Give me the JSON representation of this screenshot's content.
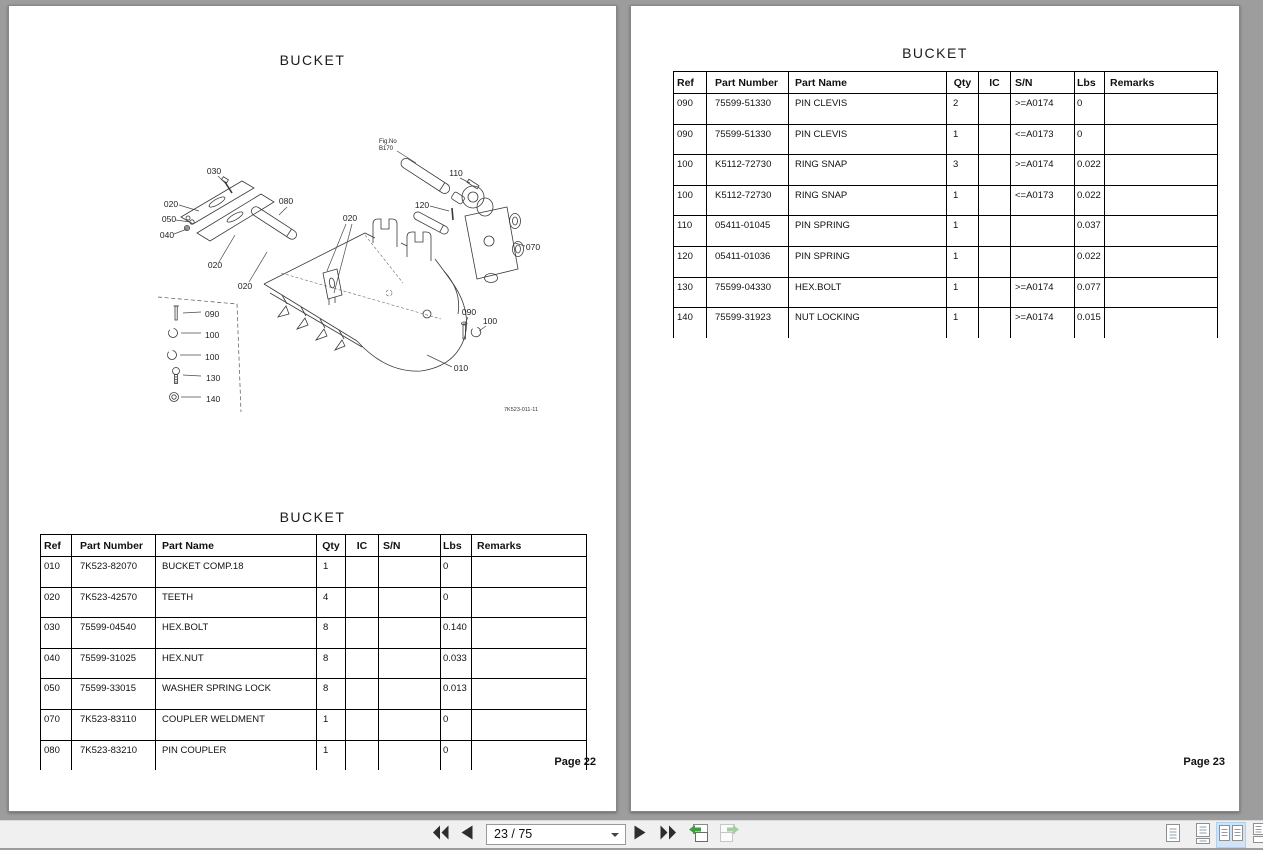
{
  "pages": {
    "left": {
      "title": "BUCKET",
      "table_title": "BUCKET",
      "footer": "Page 22",
      "diagram": {
        "fig_no_line1": "Fig.No",
        "fig_no_line2": "B170",
        "drawing_number": "7K523-011-11",
        "callouts": {
          "c030": "030",
          "c020a": "020",
          "c050": "050",
          "c040": "040",
          "c020b": "020",
          "c020c": "020",
          "c080": "080",
          "c020d": "020",
          "c110": "110",
          "c120": "120",
          "c070": "070",
          "c090L": "090",
          "c100La": "100",
          "c100Lb": "100",
          "c130": "130",
          "c140": "140",
          "c090R": "090",
          "c100R": "100",
          "c010": "010"
        }
      },
      "table": {
        "headers": [
          "Ref",
          "Part Number",
          "Part Name",
          "Qty",
          "IC",
          "S/N",
          "Lbs",
          "Remarks"
        ],
        "rows": [
          [
            "010",
            "7K523-82070",
            "BUCKET COMP.18",
            "1",
            "",
            "",
            "0",
            ""
          ],
          [
            "020",
            "7K523-42570",
            "TEETH",
            "4",
            "",
            "",
            "0",
            ""
          ],
          [
            "030",
            "75599-04540",
            "HEX.BOLT",
            "8",
            "",
            "",
            "0.140",
            ""
          ],
          [
            "040",
            "75599-31025",
            "HEX.NUT",
            "8",
            "",
            "",
            "0.033",
            ""
          ],
          [
            "050",
            "75599-33015",
            "WASHER SPRING LOCK",
            "8",
            "",
            "",
            "0.013",
            ""
          ],
          [
            "070",
            "7K523-83110",
            "COUPLER WELDMENT",
            "1",
            "",
            "",
            "0",
            ""
          ],
          [
            "080",
            "7K523-83210",
            "PIN COUPLER",
            "1",
            "",
            "",
            "0",
            ""
          ]
        ]
      }
    },
    "right": {
      "title": "BUCKET",
      "footer": "Page 23",
      "table": {
        "headers": [
          "Ref",
          "Part Number",
          "Part Name",
          "Qty",
          "IC",
          "S/N",
          "Lbs",
          "Remarks"
        ],
        "rows": [
          [
            "090",
            "75599-51330",
            "PIN CLEVIS",
            "2",
            "",
            ">=A0174",
            "0",
            ""
          ],
          [
            "090",
            "75599-51330",
            "PIN CLEVIS",
            "1",
            "",
            "<=A0173",
            "0",
            ""
          ],
          [
            "100",
            "K5112-72730",
            "RING SNAP",
            "3",
            "",
            ">=A0174",
            "0.022",
            ""
          ],
          [
            "100",
            "K5112-72730",
            "RING SNAP",
            "1",
            "",
            "<=A0173",
            "0.022",
            ""
          ],
          [
            "110",
            "05411-01045",
            "PIN SPRING",
            "1",
            "",
            "",
            "0.037",
            ""
          ],
          [
            "120",
            "05411-01036",
            "PIN SPRING",
            "1",
            "",
            "",
            "0.022",
            ""
          ],
          [
            "130",
            "75599-04330",
            "HEX.BOLT",
            "1",
            "",
            ">=A0174",
            "0.077",
            ""
          ],
          [
            "140",
            "75599-31923",
            "NUT LOCKING",
            "1",
            "",
            ">=A0174",
            "0.015",
            ""
          ]
        ]
      }
    }
  },
  "toolbar": {
    "page_indicator": "23 / 75",
    "icons": {
      "first_page": "first-page-icon",
      "previous_page": "previous-page-icon",
      "next_page": "next-page-icon",
      "last_page": "last-page-icon",
      "previous_view": "previous-view-icon",
      "next_view": "next-view-icon",
      "single_page_view": "single-page-view-icon",
      "continuous_view": "continuous-view-icon",
      "two_page_view": "two-page-view-icon",
      "two_page_continuous_view": "two-page-continuous-view-icon"
    },
    "selected_view": "two-page-view"
  },
  "colors": {
    "canvas_bg": "#9d9d9d",
    "page_bg": "#ffffff",
    "toolbar_bg": "#f0f0f0",
    "selected_view_bg": "#cfe4f8",
    "nav_icon": "#2d2d2d",
    "view_arrow_green": "#3e9d3e",
    "table_border": "#000000"
  }
}
